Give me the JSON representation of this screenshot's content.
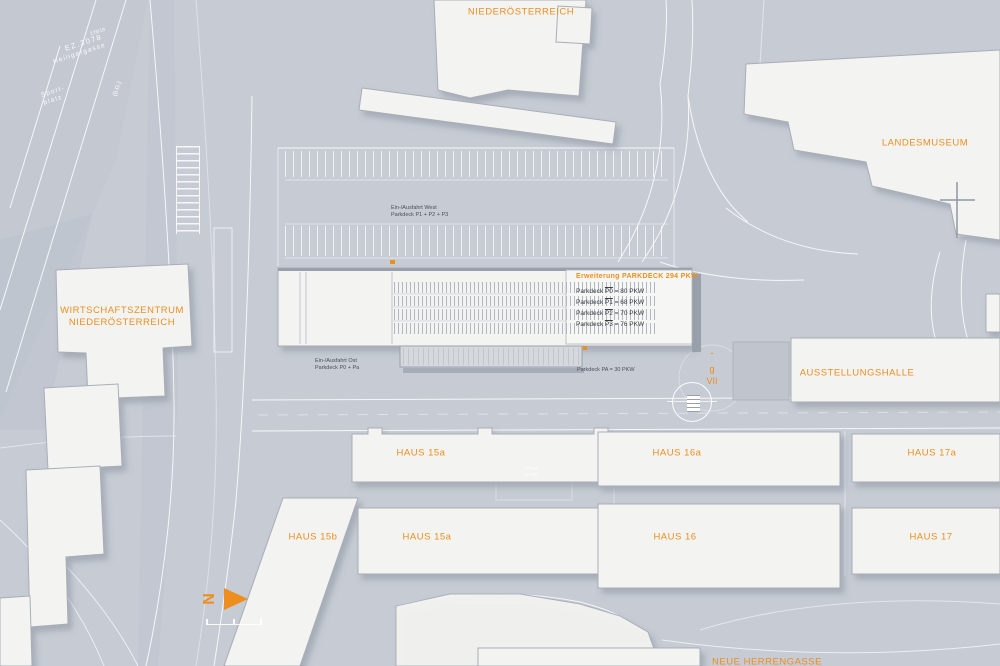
{
  "colors": {
    "accent": "#ee8e1e",
    "background": "#c6cbd4",
    "building": "#f3f3f1",
    "road_line": "#ffffff"
  },
  "labels": {
    "niederoesterreich": "NIEDERÖSTERREICH",
    "landesmuseum": "LANDESMUSEUM",
    "wirtschaftszentrum_line1": "WIRTSCHAFTSZENTRUM",
    "wirtschaftszentrum_line2": "NIEDERÖSTERREICH",
    "ausstellungshalle": "AUSSTELLUNGSHALLE",
    "haus_15a_nord": "HAUS 15a",
    "haus_16a": "HAUS 16a",
    "haus_17a": "HAUS 17a",
    "haus_15b": "HAUS 15b",
    "haus_15a_sued": "HAUS 15a",
    "haus_16": "HAUS 16",
    "haus_17": "HAUS 17",
    "neue_herrengasse": "NEUE HERRENGASSE"
  },
  "parking_panel": {
    "title": "Erweiterung PARKDECK 294 PKW",
    "rows": [
      {
        "prefix": "Parkdeck ",
        "code": "P0",
        "suffix": " = 80 PKW"
      },
      {
        "prefix": "Parkdeck ",
        "code": "P1",
        "suffix": " = 68 PKW"
      },
      {
        "prefix": "Parkdeck ",
        "code": "P2",
        "suffix": " = 70 PKW"
      },
      {
        "prefix": "Parkdeck ",
        "code": "P3",
        "suffix": " = 76 PKW"
      }
    ]
  },
  "entrances": {
    "west_line1": "Ein-/Ausfahrt West",
    "west_line2": "Parkdeck P1 + P2 + P3",
    "ost_line1": "Ein-/Ausfahrt Ost",
    "ost_line2": "Parkdeck P0 + Pa",
    "pa": "Parkdeck PA = 30 PKW"
  },
  "annotations": {
    "level_dash": "-",
    "level_g": "g",
    "level_vii": "VII",
    "parcel_number": "278/19",
    "parcel_ez": "EZ.3078",
    "parcel_street": "Heiligergasse",
    "sportplatz_line1": "Sport-",
    "sportplatz_line2": "platz",
    "road_class": "(8.G.)",
    "court_parcel": "2776/4",
    "court_area": "42.846",
    "north": "N"
  }
}
